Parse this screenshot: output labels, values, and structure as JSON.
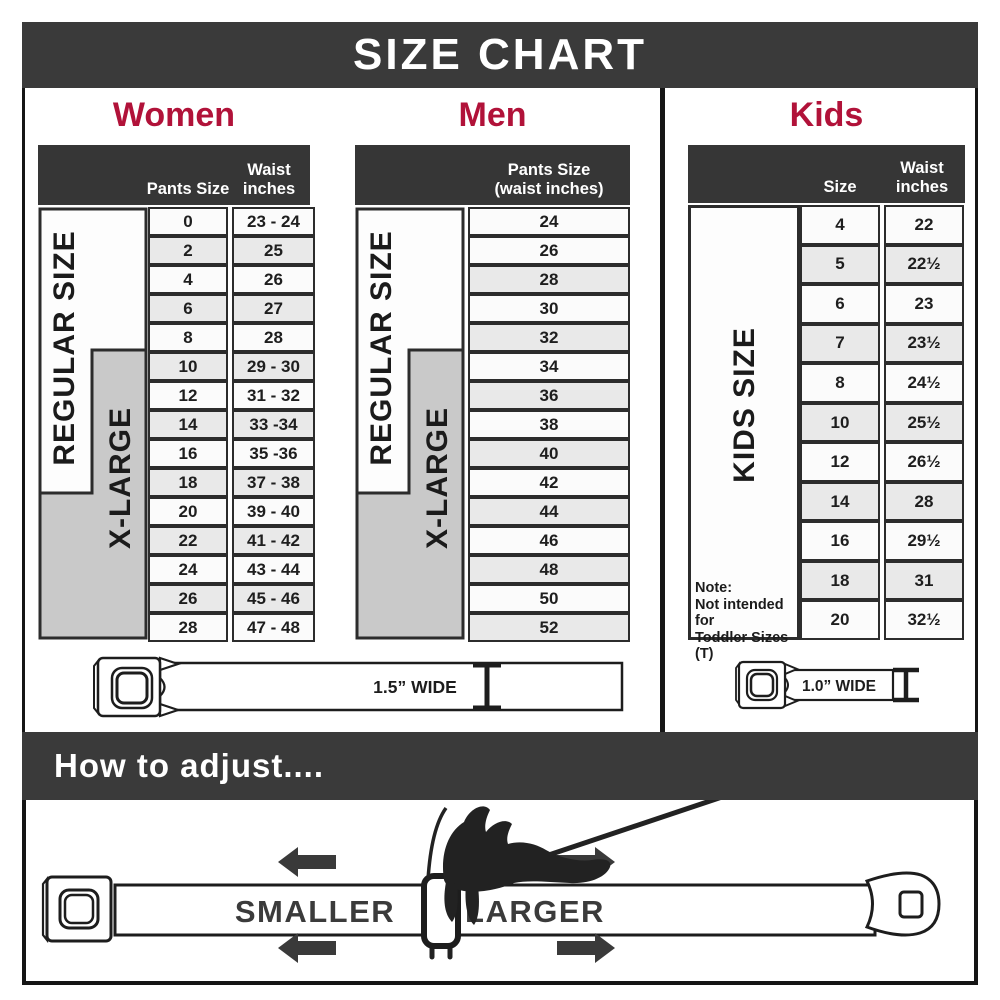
{
  "title": "SIZE CHART",
  "colors": {
    "accent_red": "#b11239",
    "header_dark": "#3a3a3a",
    "table_header_dark": "#363636",
    "row_light": "#fbfbfb",
    "row_alt": "#e9e9e9",
    "xlarge_gray": "#c9c9c9"
  },
  "women": {
    "section_label": "Women",
    "columns": {
      "size": "Pants Size",
      "waist_line1": "Waist",
      "waist_line2": "inches"
    },
    "regular_label": "REGULAR SIZE",
    "xlarge_label": "X-LARGE",
    "rows": [
      {
        "size": "0",
        "waist": "23 - 24"
      },
      {
        "size": "2",
        "waist": "25"
      },
      {
        "size": "4",
        "waist": "26"
      },
      {
        "size": "6",
        "waist": "27"
      },
      {
        "size": "8",
        "waist": "28"
      },
      {
        "size": "10",
        "waist": "29 - 30"
      },
      {
        "size": "12",
        "waist": "31 - 32"
      },
      {
        "size": "14",
        "waist": "33 -34"
      },
      {
        "size": "16",
        "waist": "35 -36"
      },
      {
        "size": "18",
        "waist": "37 - 38"
      },
      {
        "size": "20",
        "waist": "39 - 40"
      },
      {
        "size": "22",
        "waist": "41 - 42"
      },
      {
        "size": "24",
        "waist": "43 - 44"
      },
      {
        "size": "26",
        "waist": "45 - 46"
      },
      {
        "size": "28",
        "waist": "47 - 48"
      }
    ],
    "belt_width_label": "1.5” WIDE"
  },
  "men": {
    "section_label": "Men",
    "columns": {
      "header_line1": "Pants Size",
      "header_line2": "(waist inches)"
    },
    "regular_label": "REGULAR SIZE",
    "xlarge_label": "X-LARGE",
    "rows": [
      {
        "value": "24"
      },
      {
        "value": "26"
      },
      {
        "value": "28"
      },
      {
        "value": "30"
      },
      {
        "value": "32"
      },
      {
        "value": "34"
      },
      {
        "value": "36"
      },
      {
        "value": "38"
      },
      {
        "value": "40"
      },
      {
        "value": "42"
      },
      {
        "value": "44"
      },
      {
        "value": "46"
      },
      {
        "value": "48"
      },
      {
        "value": "50"
      },
      {
        "value": "52"
      }
    ]
  },
  "kids": {
    "section_label": "Kids",
    "columns": {
      "size": "Size",
      "waist_line1": "Waist",
      "waist_line2": "inches"
    },
    "side_label": "KIDS SIZE",
    "note_title": "Note:",
    "note_line1": "Not intended for",
    "note_line2": "Toddler Sizes (T)",
    "rows": [
      {
        "size": "4",
        "waist": "22"
      },
      {
        "size": "5",
        "waist": "22½"
      },
      {
        "size": "6",
        "waist": "23"
      },
      {
        "size": "7",
        "waist": "23½"
      },
      {
        "size": "8",
        "waist": "24½"
      },
      {
        "size": "10",
        "waist": "25½"
      },
      {
        "size": "12",
        "waist": "26½"
      },
      {
        "size": "14",
        "waist": "28"
      },
      {
        "size": "16",
        "waist": "29½"
      },
      {
        "size": "18",
        "waist": "31"
      },
      {
        "size": "20",
        "waist": "32½"
      }
    ],
    "belt_width_label": "1.0” WIDE"
  },
  "adjust": {
    "title": "How to adjust....",
    "smaller_label": "SMALLER",
    "larger_label": "LARGER"
  }
}
